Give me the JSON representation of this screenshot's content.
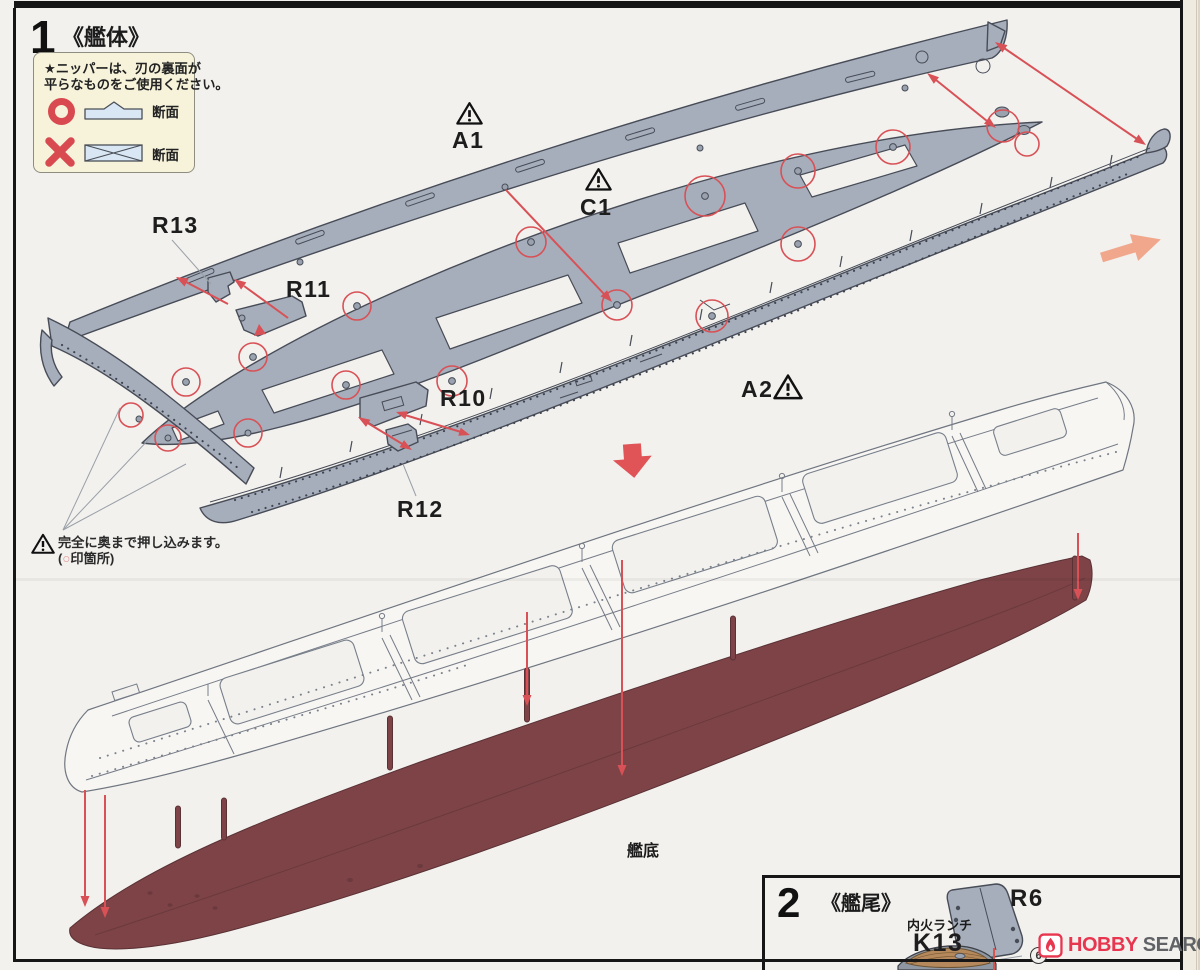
{
  "colors": {
    "page_bg": "#f2f1ee",
    "part_gray": "#a6aebb",
    "hull_red": "#7d4346",
    "arrow_red": "#d85156",
    "accent_red": "#d84a50",
    "diagram_blue": "#d8e7f3",
    "note_bg": "#f7f3db",
    "orange_arrow": "#f0a78c",
    "logo_red": "#e8364f",
    "boat_deck_tan": "#b5895b"
  },
  "step1": {
    "number": "1",
    "title": "《艦体》"
  },
  "nipper_note": {
    "line1": "★ニッパーは、刃の裏面が",
    "line2": "平らなものをご使用ください。",
    "good_caption": "断面",
    "bad_caption": "断面"
  },
  "part_labels": {
    "a1": "A1",
    "c1": "C1",
    "a2": "A2",
    "r13": "R13",
    "r11": "R11",
    "r10": "R10",
    "r12": "R12"
  },
  "push_note": {
    "line1": "完全に奥まで押し込みます。",
    "line2_open": "(",
    "line2_mark": "○",
    "line2_rest": "印箇所)"
  },
  "hull_bottom_label": "艦底",
  "step2": {
    "number": "2",
    "title": "《艦尾》",
    "r6_label": "R6",
    "k13_caption": "内火ランチ",
    "k13_label": "K13",
    "circled_number": "6"
  },
  "watermark": {
    "brand_red": "HOBBY",
    "brand_gray": "SEARCH"
  }
}
